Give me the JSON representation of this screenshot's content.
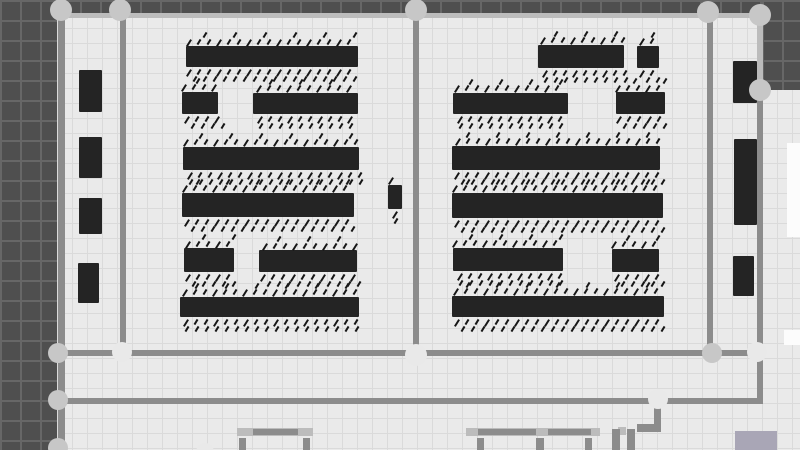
{
  "canvas": {
    "width": 800,
    "height": 450
  },
  "palette": {
    "floor_bg": "#eaeaea",
    "floor_grid": "#dadada",
    "outside_bg": "#4f4f4f",
    "outside_grid": "#676767",
    "wall": "#8c8c8c",
    "wall_light": "#bcbcbc",
    "node": "#c7c7c7",
    "node_light": "#e9e9e9",
    "shelf": "#242424",
    "hatch": "#161616",
    "fixture": "#a9a6b6",
    "white_patch": "#fcfcfc"
  },
  "outside_regions": [
    {
      "x": 0,
      "y": 0,
      "w": 57,
      "h": 450
    },
    {
      "x": 0,
      "y": 0,
      "w": 800,
      "h": 13
    },
    {
      "x": 762,
      "y": 0,
      "w": 38,
      "h": 90
    }
  ],
  "white_patches": [
    {
      "x": 787,
      "y": 143,
      "w": 13,
      "h": 94
    },
    {
      "x": 784,
      "y": 330,
      "w": 16,
      "h": 15
    }
  ],
  "walls": [
    {
      "x": 58,
      "y": 11,
      "w": 7,
      "h": 439,
      "tone": "wall"
    },
    {
      "x": 120,
      "y": 11,
      "w": 6,
      "h": 344,
      "tone": "wall"
    },
    {
      "x": 413,
      "y": 11,
      "w": 6,
      "h": 344,
      "tone": "wall"
    },
    {
      "x": 707,
      "y": 11,
      "w": 6,
      "h": 343,
      "tone": "wall"
    },
    {
      "x": 757,
      "y": 13,
      "w": 6,
      "h": 76,
      "tone": "light"
    },
    {
      "x": 757,
      "y": 88,
      "w": 6,
      "h": 264,
      "tone": "wall"
    },
    {
      "x": 757,
      "y": 356,
      "w": 6,
      "h": 46,
      "tone": "wall"
    },
    {
      "x": 60,
      "y": 13,
      "w": 700,
      "h": 5,
      "tone": "light"
    },
    {
      "x": 58,
      "y": 350,
      "w": 702,
      "h": 6,
      "tone": "wall"
    },
    {
      "x": 58,
      "y": 398,
      "w": 705,
      "h": 6,
      "tone": "wall"
    },
    {
      "x": 654,
      "y": 404,
      "w": 7,
      "h": 22,
      "tone": "wall"
    },
    {
      "x": 637,
      "y": 424,
      "w": 24,
      "h": 8,
      "tone": "wall"
    },
    {
      "x": 237,
      "y": 428,
      "w": 76,
      "h": 8,
      "tone": "light"
    },
    {
      "x": 253,
      "y": 429,
      "w": 45,
      "h": 6,
      "tone": "wall"
    },
    {
      "x": 239,
      "y": 438,
      "w": 7,
      "h": 12,
      "tone": "wall"
    },
    {
      "x": 303,
      "y": 438,
      "w": 7,
      "h": 12,
      "tone": "wall"
    },
    {
      "x": 466,
      "y": 428,
      "w": 134,
      "h": 8,
      "tone": "light"
    },
    {
      "x": 478,
      "y": 429,
      "w": 58,
      "h": 6,
      "tone": "wall"
    },
    {
      "x": 548,
      "y": 429,
      "w": 43,
      "h": 6,
      "tone": "wall"
    },
    {
      "x": 477,
      "y": 438,
      "w": 7,
      "h": 12,
      "tone": "wall"
    },
    {
      "x": 536,
      "y": 438,
      "w": 8,
      "h": 12,
      "tone": "wall"
    },
    {
      "x": 585,
      "y": 438,
      "w": 7,
      "h": 12,
      "tone": "wall"
    },
    {
      "x": 618,
      "y": 427,
      "w": 8,
      "h": 8,
      "tone": "light"
    },
    {
      "x": 612,
      "y": 429,
      "w": 8,
      "h": 21,
      "tone": "wall"
    },
    {
      "x": 627,
      "y": 429,
      "w": 8,
      "h": 21,
      "tone": "wall"
    }
  ],
  "nodes": [
    {
      "cx": 61,
      "cy": 10,
      "r": 11,
      "tone": "node"
    },
    {
      "cx": 120,
      "cy": 10,
      "r": 11,
      "tone": "node"
    },
    {
      "cx": 416,
      "cy": 10,
      "r": 11,
      "tone": "node"
    },
    {
      "cx": 708,
      "cy": 12,
      "r": 11,
      "tone": "node"
    },
    {
      "cx": 760,
      "cy": 15,
      "r": 11,
      "tone": "node"
    },
    {
      "cx": 760,
      "cy": 90,
      "r": 11,
      "tone": "node"
    },
    {
      "cx": 58,
      "cy": 353,
      "r": 10,
      "tone": "node"
    },
    {
      "cx": 122,
      "cy": 352,
      "r": 10,
      "tone": "light"
    },
    {
      "cx": 416,
      "cy": 355,
      "r": 11,
      "tone": "light"
    },
    {
      "cx": 712,
      "cy": 353,
      "r": 10,
      "tone": "node"
    },
    {
      "cx": 757,
      "cy": 352,
      "r": 10,
      "tone": "light"
    },
    {
      "cx": 58,
      "cy": 400,
      "r": 10,
      "tone": "node"
    },
    {
      "cx": 658,
      "cy": 399,
      "r": 10,
      "tone": "light"
    },
    {
      "cx": 58,
      "cy": 448,
      "r": 10,
      "tone": "node"
    },
    {
      "cx": 205,
      "cy": 452,
      "r": 9,
      "tone": "light"
    }
  ],
  "shelves": [
    {
      "x": 79,
      "y": 70,
      "w": 23,
      "h": 42,
      "hatch": false
    },
    {
      "x": 79,
      "y": 137,
      "w": 23,
      "h": 41,
      "hatch": false
    },
    {
      "x": 79,
      "y": 198,
      "w": 23,
      "h": 36,
      "hatch": false
    },
    {
      "x": 78,
      "y": 263,
      "w": 21,
      "h": 40,
      "hatch": false
    },
    {
      "x": 186,
      "y": 46,
      "w": 172,
      "h": 21,
      "hatch": true
    },
    {
      "x": 182,
      "y": 92,
      "w": 36,
      "h": 22,
      "hatch": true
    },
    {
      "x": 253,
      "y": 93,
      "w": 105,
      "h": 21,
      "hatch": true
    },
    {
      "x": 183,
      "y": 147,
      "w": 176,
      "h": 23,
      "hatch": true
    },
    {
      "x": 182,
      "y": 193,
      "w": 172,
      "h": 24,
      "hatch": true
    },
    {
      "x": 184,
      "y": 248,
      "w": 50,
      "h": 24,
      "hatch": true
    },
    {
      "x": 259,
      "y": 250,
      "w": 98,
      "h": 22,
      "hatch": true
    },
    {
      "x": 180,
      "y": 297,
      "w": 179,
      "h": 20,
      "hatch": true
    },
    {
      "x": 388,
      "y": 185,
      "w": 14,
      "h": 24,
      "hatch": true
    },
    {
      "x": 538,
      "y": 45,
      "w": 86,
      "h": 23,
      "hatch": true
    },
    {
      "x": 637,
      "y": 46,
      "w": 22,
      "h": 22,
      "hatch": true
    },
    {
      "x": 453,
      "y": 93,
      "w": 115,
      "h": 21,
      "hatch": true
    },
    {
      "x": 616,
      "y": 92,
      "w": 49,
      "h": 22,
      "hatch": true
    },
    {
      "x": 452,
      "y": 146,
      "w": 208,
      "h": 24,
      "hatch": true
    },
    {
      "x": 452,
      "y": 193,
      "w": 211,
      "h": 25,
      "hatch": true
    },
    {
      "x": 453,
      "y": 248,
      "w": 110,
      "h": 23,
      "hatch": true
    },
    {
      "x": 612,
      "y": 249,
      "w": 47,
      "h": 23,
      "hatch": true
    },
    {
      "x": 452,
      "y": 296,
      "w": 212,
      "h": 21,
      "hatch": true
    },
    {
      "x": 733,
      "y": 61,
      "w": 24,
      "h": 42,
      "hatch": false
    },
    {
      "x": 734,
      "y": 139,
      "w": 23,
      "h": 86,
      "hatch": false
    },
    {
      "x": 733,
      "y": 256,
      "w": 21,
      "h": 40,
      "hatch": false
    }
  ],
  "fixtures": [
    {
      "x": 735,
      "y": 431,
      "w": 42,
      "h": 19
    }
  ]
}
